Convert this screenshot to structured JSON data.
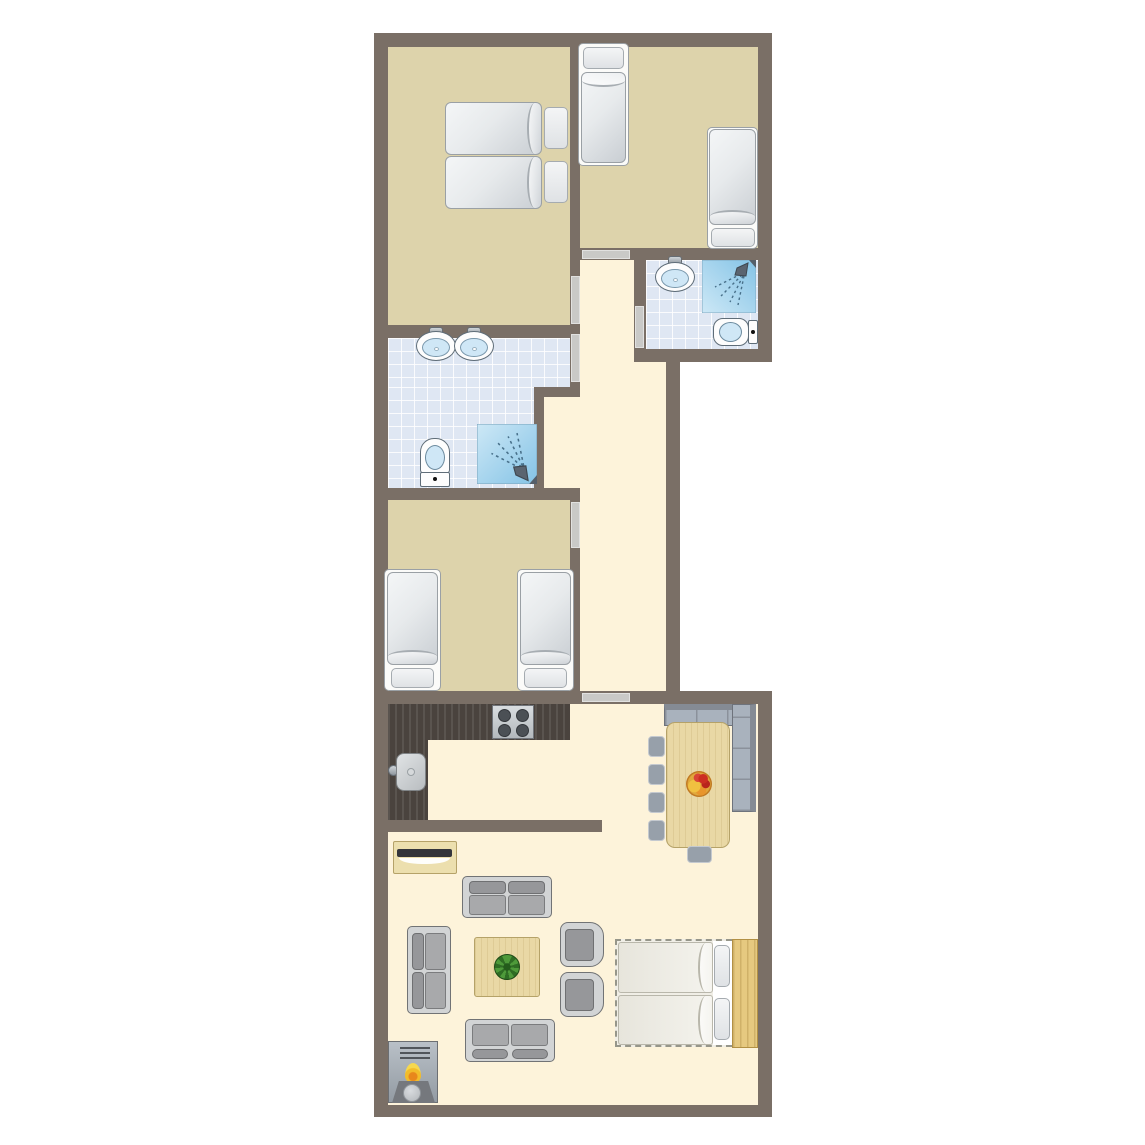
{
  "title": "apartment-floor-plan",
  "palette": {
    "wall": "#7a6f66",
    "tan": "#ddd3ab",
    "cream": "#fdf3da",
    "tile": "#dfe7f3",
    "door": "#c9c9c7",
    "counter": "#4a433e",
    "wood": "#e9d8a5",
    "wood_border": "#b5a268",
    "sofa_frame": "#d2d4d5",
    "cushion": "#a8a9ab",
    "cushion_dark": "#96979a",
    "bench": "#a9b2bd",
    "fix_blue": "#cfe7f6",
    "shower_a": "#cde8f6",
    "shower_b": "#84c3e6",
    "green": "#3f8c2e",
    "flame": "#f2bc2a",
    "headboard": "#e6c980"
  },
  "rooms": [
    {
      "name": "bedroom-top-left",
      "type": "bedroom",
      "floor": "tan",
      "furniture": [
        "double-bed (two mattresses, two pillows)"
      ]
    },
    {
      "name": "bedroom-top-right",
      "type": "bedroom",
      "floor": "tan",
      "furniture": [
        "single-bed head-north",
        "single-bed head-south"
      ]
    },
    {
      "name": "bathroom-ensuite",
      "type": "bathroom",
      "floor": "tile",
      "furniture": [
        "sink",
        "shower",
        "toilet"
      ]
    },
    {
      "name": "bathroom-main",
      "type": "bathroom",
      "floor": "tile",
      "furniture": [
        "sink",
        "sink",
        "toilet",
        "shower"
      ]
    },
    {
      "name": "bedroom-bottom-left",
      "type": "bedroom",
      "floor": "tan",
      "furniture": [
        "single-bed",
        "single-bed"
      ]
    },
    {
      "name": "hallway",
      "type": "hall",
      "floor": "cream",
      "furniture": []
    },
    {
      "name": "living-kitchen",
      "type": "living",
      "floor": "cream",
      "furniture": [
        "l-shaped-kitchen-counter",
        "stove-4-burners",
        "kitchen-sink",
        "corner-bench",
        "dining-table",
        "fruit-bowl",
        "5-dining-chairs",
        "tv-sideboard",
        "sofa",
        "sofa",
        "sofa",
        "armchair",
        "armchair",
        "coffee-table",
        "plant",
        "fireplace",
        "double-sofa-bed-dashed",
        "wood-headboard"
      ]
    }
  ],
  "counts": {
    "bedrooms": 3,
    "bathrooms": 2,
    "doors": 6,
    "single_beds": 4,
    "double_beds": 2,
    "sofas": 3,
    "armchairs": 2,
    "dining_chairs": 5,
    "sinks": 3,
    "toilets": 2,
    "showers": 2
  }
}
